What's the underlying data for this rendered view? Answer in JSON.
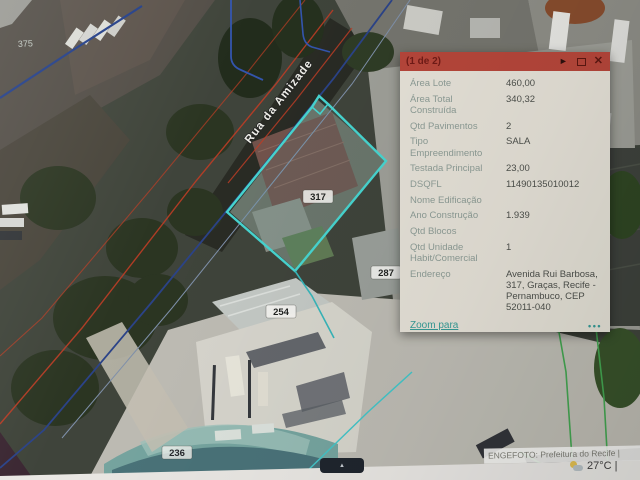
{
  "map": {
    "street_label": "Rua da Amizade",
    "parcel_labels": {
      "p375": "375",
      "p317": "317",
      "p287": "287",
      "p254": "254",
      "p236": "236"
    },
    "attribution": "ENGEFOTO: Prefeitura do Recife |",
    "weather": "27°C |"
  },
  "popup": {
    "title": "(1 de 2)",
    "icons": {
      "next": "►",
      "close": "✕"
    },
    "fields": [
      {
        "label": "Área Lote",
        "value": "460,00"
      },
      {
        "label": "Área Total Construída",
        "value": "340,32"
      },
      {
        "label": "Qtd Pavimentos",
        "value": "2"
      },
      {
        "label": "Tipo Empreendimento",
        "value": "SALA"
      },
      {
        "label": "Testada Principal",
        "value": "23,00"
      },
      {
        "label": "DSQFL",
        "value": "11490135010012"
      },
      {
        "label": "Nome Edificação",
        "value": ""
      },
      {
        "label": "Ano Construção",
        "value": "1.939"
      },
      {
        "label": "Qtd Blocos",
        "value": ""
      },
      {
        "label": "Qtd Unidade Habit/Comercial",
        "value": "1"
      },
      {
        "label": "Endereço",
        "value": "Avenida Rui Barbosa, 317, Graças, Recife - Pernambuco, CEP 52011-040"
      }
    ],
    "zoom_link": "Zoom para",
    "menu_dots": "•••"
  },
  "colors": {
    "popup_header": "#bc4336",
    "popup_body": "#e8e4d9",
    "popup_label": "#8d9d96",
    "popup_value": "#4b4e49",
    "link_teal": "#2f9e98",
    "parcel_cyan": "#3fd9d4",
    "cadastral_red": "#c43a20",
    "line_blue": "#27418c",
    "line_green": "#3da84c"
  }
}
